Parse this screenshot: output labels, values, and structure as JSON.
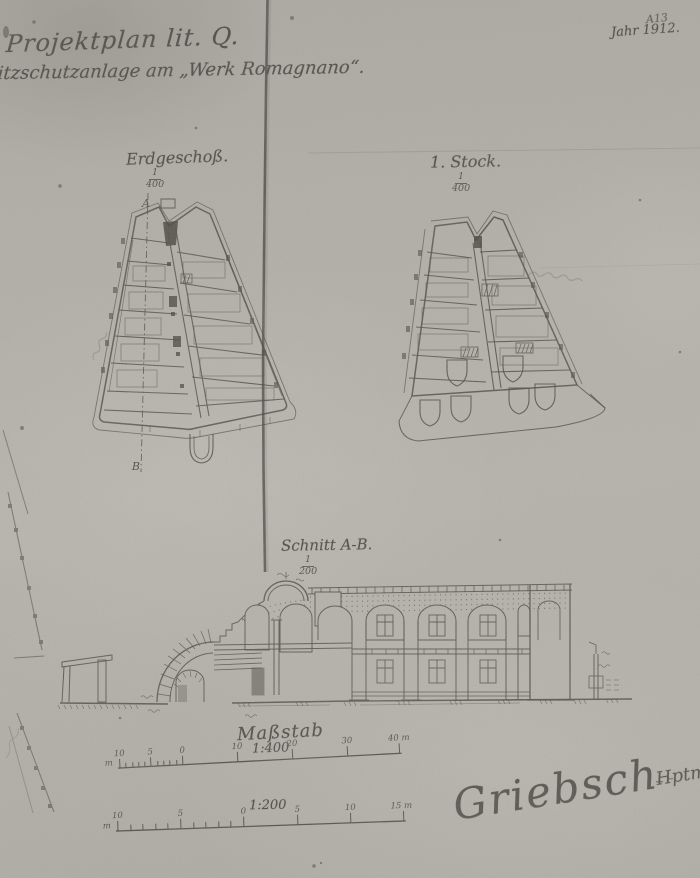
{
  "colors": {
    "paper": "#bcbab2",
    "ink": "#36342e",
    "pencil": "#75736a",
    "fold_line": "#26241f"
  },
  "header": {
    "title": "Projektplan lit. Q.",
    "subtitle": "litzschutzanlage am „Werk Romagnano“.",
    "doc_number": "A13",
    "year_label": "Jahr 1912."
  },
  "plans": {
    "ground_floor": {
      "label": "Erdgeschoß.",
      "scale_numerator": "1",
      "scale_denominator": "400",
      "section_marker_top": "A",
      "section_marker_bottom": "B"
    },
    "first_floor": {
      "label": "1. Stock.",
      "scale_numerator": "1",
      "scale_denominator": "400"
    }
  },
  "section_view": {
    "label": "Schnitt A-B.",
    "scale_numerator": "1",
    "scale_denominator": "200"
  },
  "scale_bars": {
    "title": "Maßstab",
    "bar_400": {
      "ratio": "1:400",
      "unit": "m",
      "ticks": [
        "10",
        "5",
        "0",
        "10",
        "20",
        "30",
        "40 m"
      ]
    },
    "bar_200": {
      "ratio": "1:200",
      "unit": "m",
      "ticks": [
        "10",
        "5",
        "0",
        "5",
        "10",
        "15 m"
      ]
    }
  },
  "signature": {
    "name": "Griebsch",
    "rank": "Hptm."
  }
}
